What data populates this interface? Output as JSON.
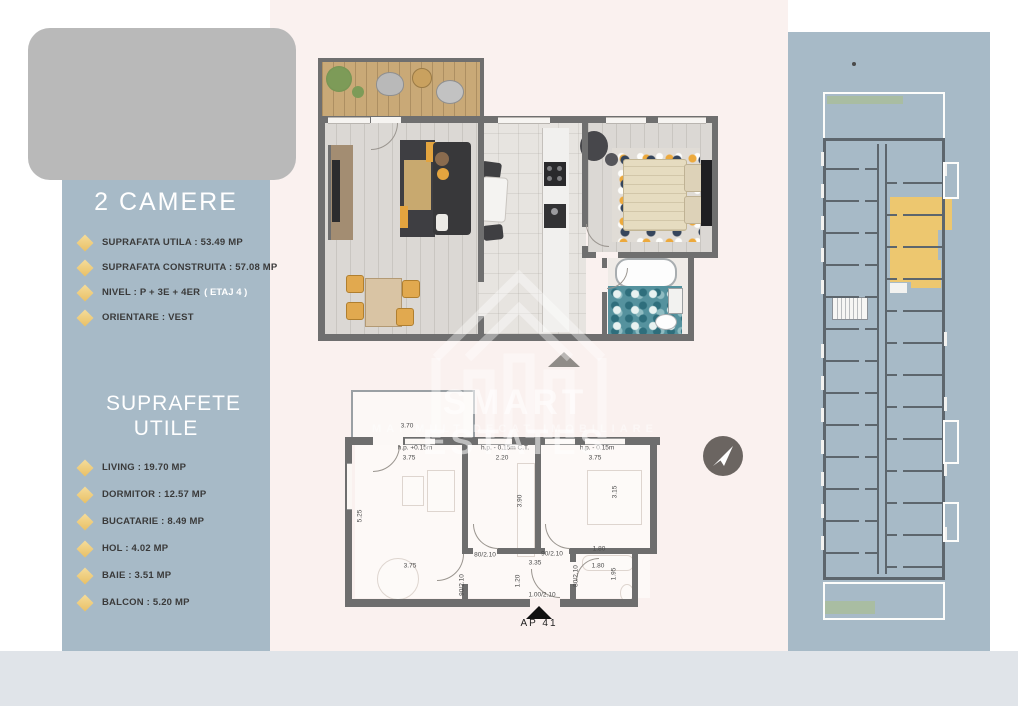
{
  "brand": {
    "name": "SMART ESTATES",
    "tagline": "MAI MULT DECAT IMOBILIARE"
  },
  "sidebar": {
    "title": "2 CAMERE",
    "details": [
      {
        "text": "SUPRAFATA UTILA : 53.49 MP",
        "note": ""
      },
      {
        "text": "SUPRAFATA CONSTRUITA : 57.08 MP",
        "note": ""
      },
      {
        "text": "NIVEL : P + 3E + 4ER",
        "note": "( ETAJ 4 )"
      },
      {
        "text": "ORIENTARE : VEST",
        "note": ""
      }
    ],
    "surfaces": {
      "title": "SUPRAFETE UTILE",
      "items": [
        "LIVING : 19.70 MP",
        "DORMITOR : 12.57 MP",
        "BUCATARIE : 8.49 MP",
        "HOL : 4.02 MP",
        "BAIE : 3.51 MP",
        "BALCON : 5.20 MP"
      ]
    }
  },
  "plan2d": {
    "apartment_label": "AP 41",
    "dimensions": [
      {
        "t": "3.70",
        "x": 62,
        "y": 38
      },
      {
        "t": "h.p. +0.15m",
        "x": 70,
        "y": 60
      },
      {
        "t": "3.75",
        "x": 64,
        "y": 70
      },
      {
        "t": "h.p. - 0.15m  C.T.",
        "x": 160,
        "y": 60
      },
      {
        "t": "2.20",
        "x": 157,
        "y": 70
      },
      {
        "t": "h.p. - 0.15m",
        "x": 252,
        "y": 60
      },
      {
        "t": "3.75",
        "x": 250,
        "y": 70
      },
      {
        "t": "5.25",
        "x": 15,
        "y": 128,
        "v": 1
      },
      {
        "t": "3.75",
        "x": 65,
        "y": 178
      },
      {
        "t": "3.90",
        "x": 175,
        "y": 113,
        "v": 1
      },
      {
        "t": "3.15",
        "x": 270,
        "y": 104,
        "v": 1
      },
      {
        "t": "80/2.10",
        "x": 140,
        "y": 167
      },
      {
        "t": "90/2.10",
        "x": 207,
        "y": 166
      },
      {
        "t": "3.35",
        "x": 190,
        "y": 175
      },
      {
        "t": "1.80",
        "x": 254,
        "y": 161
      },
      {
        "t": "1.80",
        "x": 253,
        "y": 178
      },
      {
        "t": "1.95",
        "x": 269,
        "y": 186,
        "v": 1
      },
      {
        "t": "80/2.10",
        "x": 231,
        "y": 188,
        "v": 1
      },
      {
        "t": "90/2.10",
        "x": 117,
        "y": 197,
        "v": 1
      },
      {
        "t": "1.20",
        "x": 173,
        "y": 193,
        "v": 1
      },
      {
        "t": "1.00/2.10",
        "x": 197,
        "y": 207
      }
    ]
  },
  "icons": {
    "compass": "paper-plane-arrow",
    "entrance_marker_3d": "triangle-up-gray",
    "entrance_marker_2d": "triangle-up-black",
    "bullet": "diamond"
  },
  "colors": {
    "sidebar_bg": "#a7bac7",
    "right_panel_bg": "#a7bac7",
    "center_bg": "#faf1ef",
    "bottom_strip": "#e0e4e9",
    "logo_placeholder": "#b9b9b9",
    "diamond_accent": "#eec76e",
    "highlight_apartment": "#edc76f",
    "wall_gray": "#6f6f6f",
    "balcony_green": "#a9bda2",
    "watermark_white": "#ffffff"
  }
}
